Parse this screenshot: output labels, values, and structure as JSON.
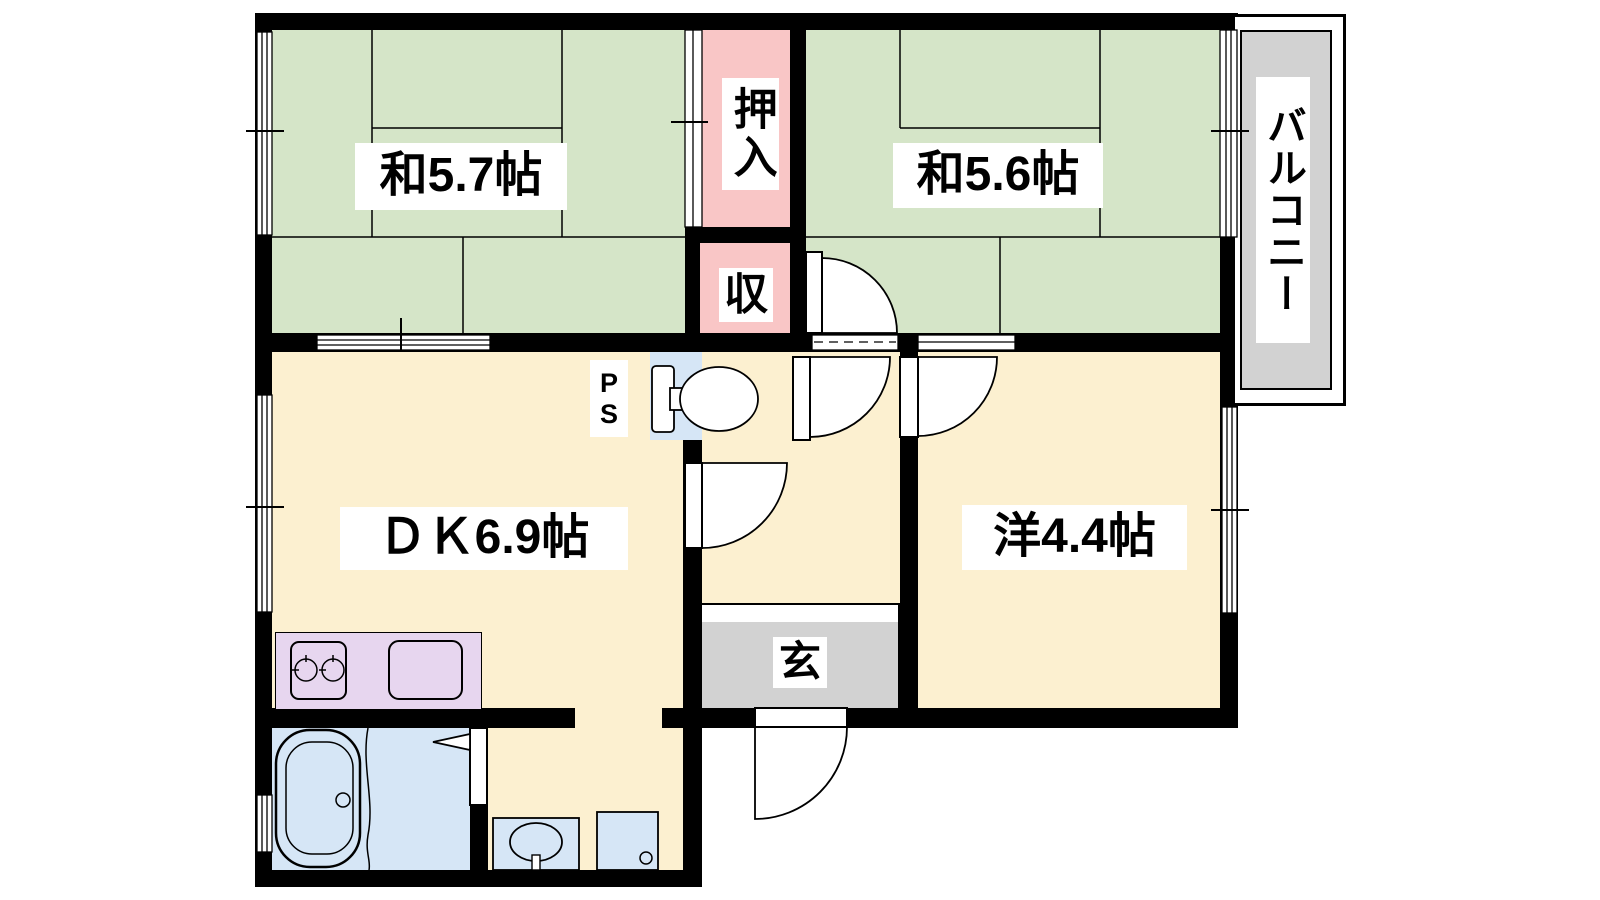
{
  "rooms": {
    "washitsu1": {
      "label": "和5.7帖"
    },
    "washitsu2": {
      "label": "和5.6帖"
    },
    "dk": {
      "label": "ＤＫ6.9帖"
    },
    "western": {
      "label": "洋4.4帖"
    },
    "oshiire": {
      "label": "押入"
    },
    "shu": {
      "label": "収"
    },
    "entrance": {
      "label": "玄"
    },
    "balcony": {
      "label": "バルコニー"
    },
    "pipe_space": {
      "line1": "P",
      "line2": "S"
    }
  },
  "colors": {
    "wall": "#000000",
    "tatami_green": "#d5e5c8",
    "closet_pink": "#f9c6c6",
    "floor_cream": "#fcf0d0",
    "water_blue": "#d6e6f6",
    "kitchen_purple": "#e7d6ef",
    "entry_gray": "#d2d2d2",
    "balcony_gray": "#d2d2d2",
    "label_bg": "#ffffff"
  }
}
